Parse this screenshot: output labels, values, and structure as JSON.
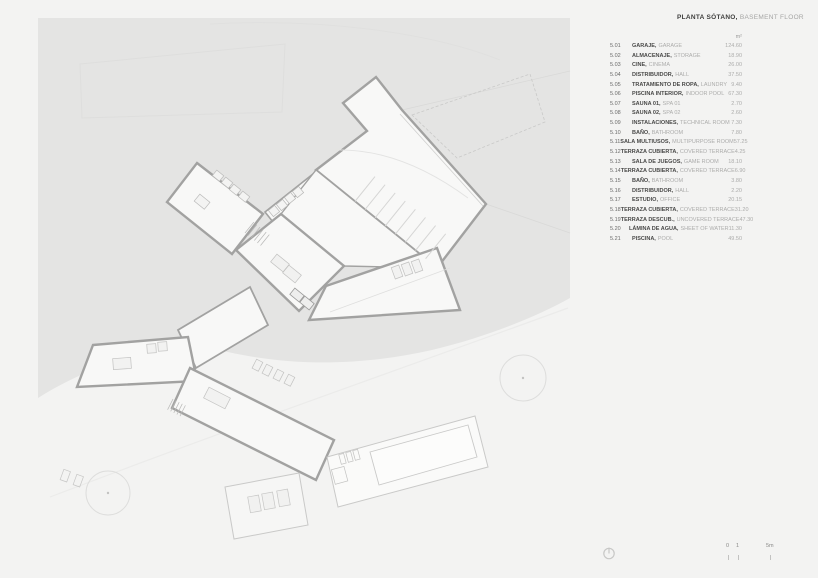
{
  "sheet": {
    "title_es": "PLANTA SÓTANO,",
    "title_en": "BASEMENT FLOOR",
    "unit": "m²"
  },
  "legend": {
    "rows": [
      {
        "code": "5.01",
        "name_es": "GARAJE",
        "name_en": "GARAGE",
        "area": "124.60"
      },
      {
        "code": "5.02",
        "name_es": "ALMACENAJE",
        "name_en": "STORAGE",
        "area": "18.90"
      },
      {
        "code": "5.03",
        "name_es": "CINE",
        "name_en": "CINEMA",
        "area": "26.00"
      },
      {
        "code": "5.04",
        "name_es": "DISTRIBUIDOR",
        "name_en": "HALL",
        "area": "37.50"
      },
      {
        "code": "5.05",
        "name_es": "TRATAMIENTO DE ROPA",
        "name_en": "LAUNDRY",
        "area": "9.40"
      },
      {
        "code": "5.06",
        "name_es": "PISCINA INTERIOR",
        "name_en": "INDOOR POOL",
        "area": "67.30"
      },
      {
        "code": "5.07",
        "name_es": "SAUNA 01",
        "name_en": "SPA 01",
        "area": "2.70"
      },
      {
        "code": "5.08",
        "name_es": "SAUNA 02",
        "name_en": "SPA 02",
        "area": "2.60"
      },
      {
        "code": "5.09",
        "name_es": "INSTALACIONES",
        "name_en": "TECHNICAL ROOM",
        "area": "7.30"
      },
      {
        "code": "5.10",
        "name_es": "BAÑO",
        "name_en": "BATHROOM",
        "area": "7.80"
      },
      {
        "code": "5.11",
        "name_es": "SALA MULTIUSOS",
        "name_en": "MULTIPURPOSE ROOM",
        "area": "57.25"
      },
      {
        "code": "5.12",
        "name_es": "TERRAZA CUBIERTA",
        "name_en": "COVERED TERRACE",
        "area": "4.25"
      },
      {
        "code": "5.13",
        "name_es": "SALA DE JUEGOS",
        "name_en": "GAME ROOM",
        "area": "18.10"
      },
      {
        "code": "5.14",
        "name_es": "TERRAZA CUBIERTA",
        "name_en": "COVERED TERRACE",
        "area": "6.90"
      },
      {
        "code": "5.15",
        "name_es": "BAÑO",
        "name_en": "BATHROOM",
        "area": "3.80"
      },
      {
        "code": "5.16",
        "name_es": "DISTRIBUIDOR",
        "name_en": "HALL",
        "area": "2.20"
      },
      {
        "code": "5.17",
        "name_es": "ESTUDIO",
        "name_en": "OFFICE",
        "area": "20.15"
      },
      {
        "code": "5.18",
        "name_es": "TERRAZA CUBIERTA",
        "name_en": "COVERED TERRACE",
        "area": "31.20"
      },
      {
        "code": "5.19",
        "name_es": "TERRAZA DESCUB.",
        "name_en": "UNCOVERED TERRACE",
        "area": "47.30"
      },
      {
        "code": "5.20",
        "name_es": "LÁMINA DE AGUA",
        "name_en": "SHEET OF WATER",
        "area": "11.30"
      },
      {
        "code": "5.21",
        "name_es": "PISCINA",
        "name_en": "POOL",
        "area": "49.50"
      }
    ]
  },
  "scale_bar": {
    "labels": [
      "0",
      "1",
      "5m"
    ]
  },
  "icons": {
    "bottom_left_symbol": "power-icon",
    "trees": "tree-icon"
  },
  "colors": {
    "background": "#f3f3f2",
    "terrain": "#e4e4e3",
    "wall": "#a2a2a1",
    "room_fill": "#f8f8f7",
    "text_dark": "#4a4a49",
    "text_light": "#acacab"
  }
}
